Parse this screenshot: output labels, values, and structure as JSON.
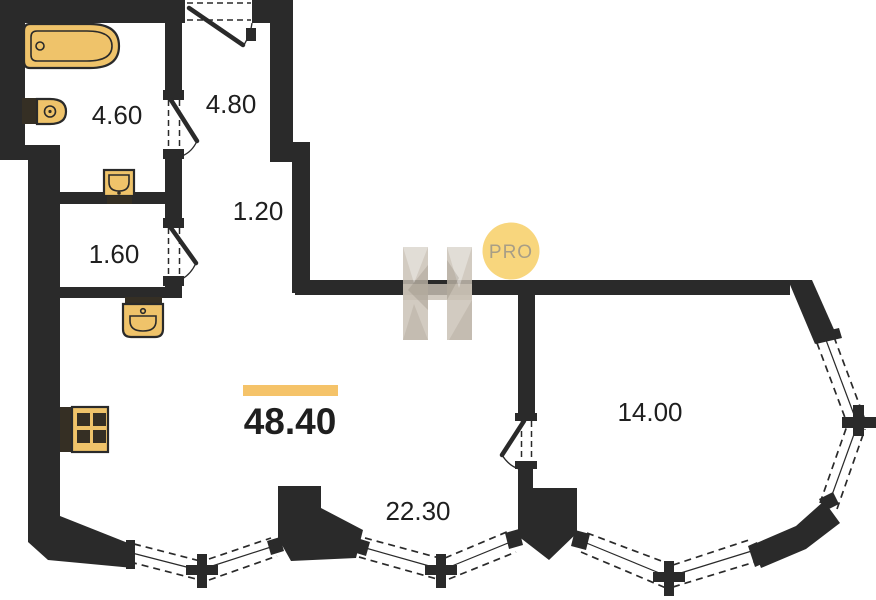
{
  "watermark": {
    "badge_label": "PRO"
  },
  "labels": {
    "bathroom": "4.60",
    "hallway": "4.80",
    "corridor": "1.20",
    "wc": "1.60",
    "total_area": "48.40",
    "living_width": "22.30",
    "bedroom": "14.00"
  },
  "colors": {
    "wall": "#2A2A2A",
    "fixture_fill": "#EFC36A",
    "fixture_dark": "#352F24",
    "accent_bar": "#F5C369",
    "badge_bg": "#F8D67D",
    "badge_text": "#A89E86",
    "watermark_fill": "#C8C0B3",
    "text": "#1F1F1F",
    "background": "#FFFFFF"
  }
}
